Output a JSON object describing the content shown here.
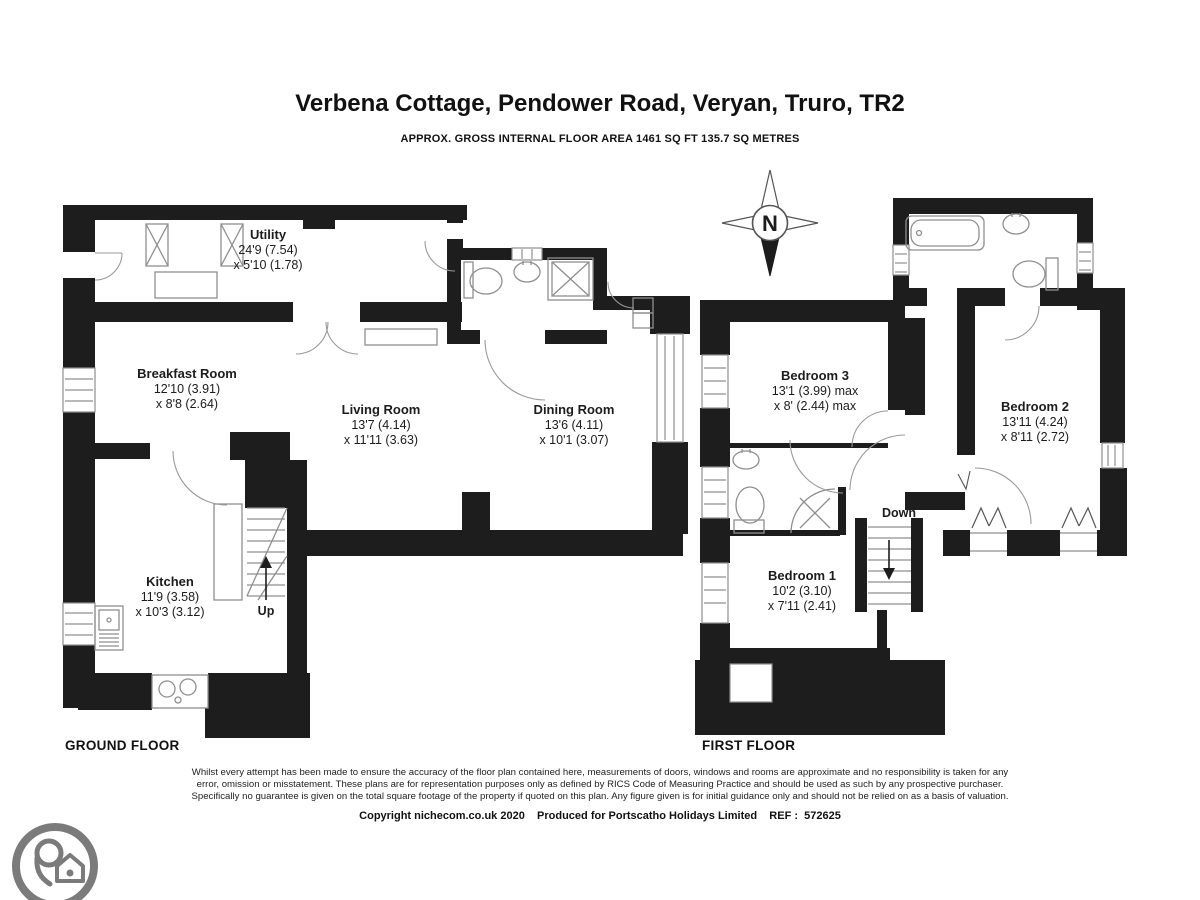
{
  "header": {
    "title": "Verbena Cottage, Pendower Road, Veryan, Truro, TR2",
    "subtitle": "APPROX. GROSS INTERNAL FLOOR AREA 1461 SQ FT 135.7 SQ METRES"
  },
  "ground_floor": {
    "label": "GROUND FLOOR",
    "stairs_label": "Up",
    "rooms": [
      {
        "name": "Utility",
        "dim1": "24'9 (7.54)",
        "dim2": "x 5'10 (1.78)"
      },
      {
        "name": "Breakfast Room",
        "dim1": "12'10 (3.91)",
        "dim2": "x 8'8 (2.64)"
      },
      {
        "name": "Living Room",
        "dim1": "13'7 (4.14)",
        "dim2": "x 11'11 (3.63)"
      },
      {
        "name": "Dining Room",
        "dim1": "13'6 (4.11)",
        "dim2": "x 10'1 (3.07)"
      },
      {
        "name": "Kitchen",
        "dim1": "11'9 (3.58)",
        "dim2": "x 10'3 (3.12)"
      }
    ]
  },
  "first_floor": {
    "label": "FIRST FLOOR",
    "stairs_label": "Down",
    "rooms": [
      {
        "name": "Bedroom 3",
        "dim1": "13'1 (3.99) max",
        "dim2": "x 8' (2.44) max"
      },
      {
        "name": "Bedroom 2",
        "dim1": "13'11 (4.24)",
        "dim2": "x 8'11 (2.72)"
      },
      {
        "name": "Bedroom 1",
        "dim1": "10'2 (3.10)",
        "dim2": "x 7'11 (2.41)"
      }
    ]
  },
  "compass": {
    "north_label": "N"
  },
  "footer": {
    "disclaimer_line1": "Whilst every attempt has been made to ensure the accuracy of the floor plan contained here, measurements of doors, windows and rooms are approximate and no responsibility is taken for any",
    "disclaimer_line2": "error, omission or misstatement. These plans are for representation purposes only as defined by RICS Code of Measuring Practice and should be used as such by any prospective purchaser.",
    "disclaimer_line3": "Specifically no guarantee is given on the total square footage of the property if quoted on this plan. Any figure given is for initial guidance only and should not be relied on as a basis of valuation.",
    "copyright": "Copyright nichecom.co.uk 2020    Produced for Portscatho Holidays Limited    REF :  572625"
  },
  "icons": {
    "compass": "compass-rose",
    "logo": "house-location-pin-logo"
  },
  "colors": {
    "wall": "#1d1d1d",
    "fixture": "#8f8f8f",
    "logo_gray": "#7b7b7b",
    "text": "#1c1c1c"
  }
}
